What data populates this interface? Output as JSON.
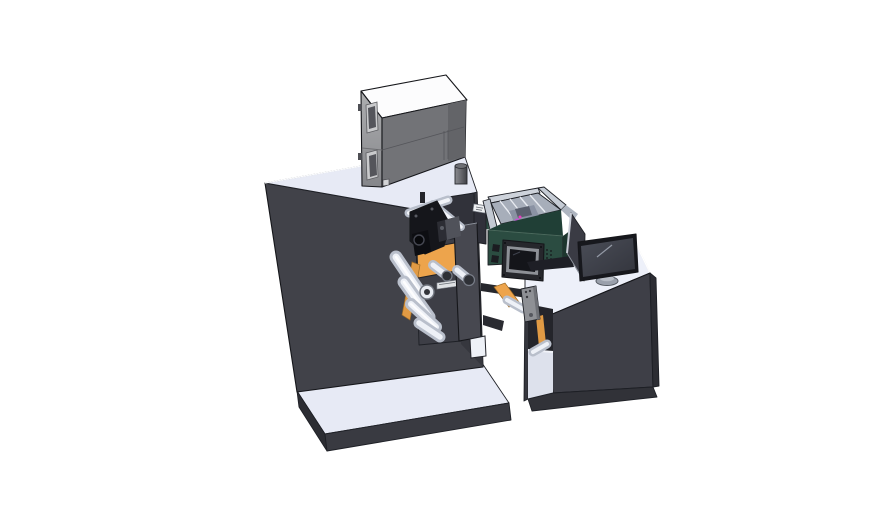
{
  "scene": {
    "kind": "3d-cad-render",
    "description": "Isometric CAD rendering of a label printing and application machine line on a white background",
    "objects": [
      "machine-cabinet",
      "base-platform",
      "top-unit-box",
      "exhaust-stack",
      "web-roller-cascade",
      "orange-web-ribbon",
      "print-head-assembly",
      "roller-support-plate",
      "end-plate",
      "parts-feeder-tray",
      "feeder-control-display",
      "web-bridge",
      "guide-bracket",
      "operator-desk",
      "desk-bay",
      "desk-plinth",
      "side-guard-panel",
      "monitor",
      "monitor-stand"
    ]
  },
  "colors": {
    "bg": "#ffffff",
    "machineBody": "#414249",
    "machineSide": "#36373e",
    "surfaceLight": "#e7eaf5",
    "platformEdge": "#393a41",
    "cubeTop": "#fcfcfd",
    "cubeLeft": "#9c9da0",
    "cubeFront": "#727377",
    "green": "#2b4c41",
    "greenDark": "#203f36",
    "orange": "#eda44c",
    "trayFloor": "#a7aeba",
    "trayWall": "#ced3db",
    "purple": "#b85ad0",
    "printheadBlack": "#15161b",
    "deskTop": "#edf0f9",
    "deskFront": "#3e3f47",
    "deskSide": "#2c2d33",
    "plinth": "#313238",
    "bayLight": "#dde1ec",
    "bracket": "#8e9095",
    "monitorBezel": "#17181d",
    "monitorScreen": "#41444d",
    "monitorBase": "#9aa0ab",
    "divider": "#3a3b44",
    "labelSticker": "#eef0f2"
  }
}
